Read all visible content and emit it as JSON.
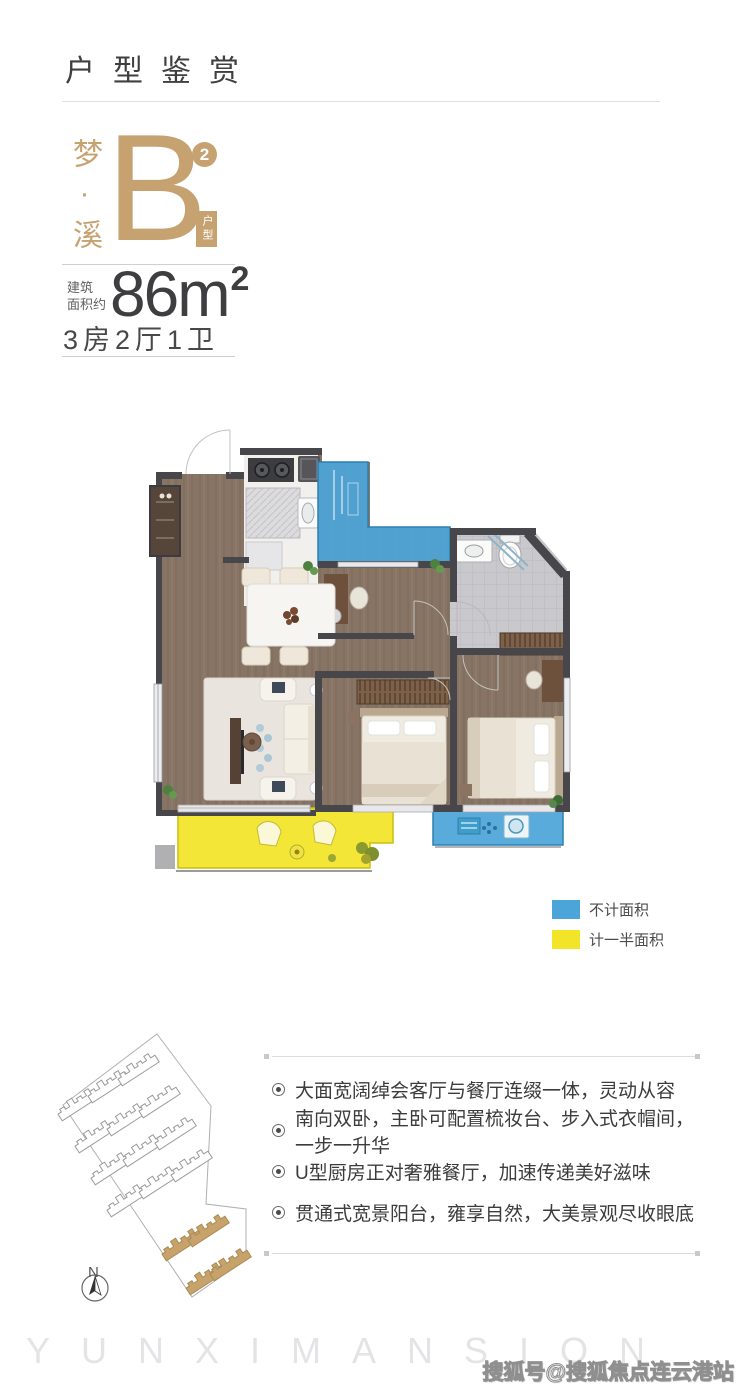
{
  "header": {
    "title": "户型鉴赏"
  },
  "unit": {
    "series_vertical": "梦·溪",
    "letter": "B",
    "superscript": "2",
    "type_label": "户型"
  },
  "area": {
    "label_line1": "建筑",
    "label_line2": "面积约",
    "value": "86",
    "unit": "m",
    "unit_sup": "2",
    "rooms": "3房2厅1卫"
  },
  "legend": {
    "items": [
      {
        "label": "不计面积",
        "color": "#4BA5D8"
      },
      {
        "label": "计一半面积",
        "color": "#F2E426"
      }
    ]
  },
  "features": {
    "items": [
      "大面宽阔绰会客厅与餐厅连缀一体，灵动从容",
      "南向双卧，主卧可配置梳妆台、步入式衣帽间，一步一升华",
      "U型厨房正对奢雅餐厅，加速传递美好滋味",
      "贯通式宽景阳台，雍享自然，大美景观尽收眼底"
    ]
  },
  "siteplan": {
    "compass_label": "N"
  },
  "footer": {
    "ghost_text": "YUNXIMANSION",
    "watermark": "搜狐号@搜狐焦点连云港站"
  },
  "colors": {
    "accent_gold": "#C6A271",
    "not_counted_blue": "#4BA5D8",
    "half_counted_yellow": "#F2E426",
    "wall_dark": "#46464B",
    "floor_wood": "#877465"
  }
}
